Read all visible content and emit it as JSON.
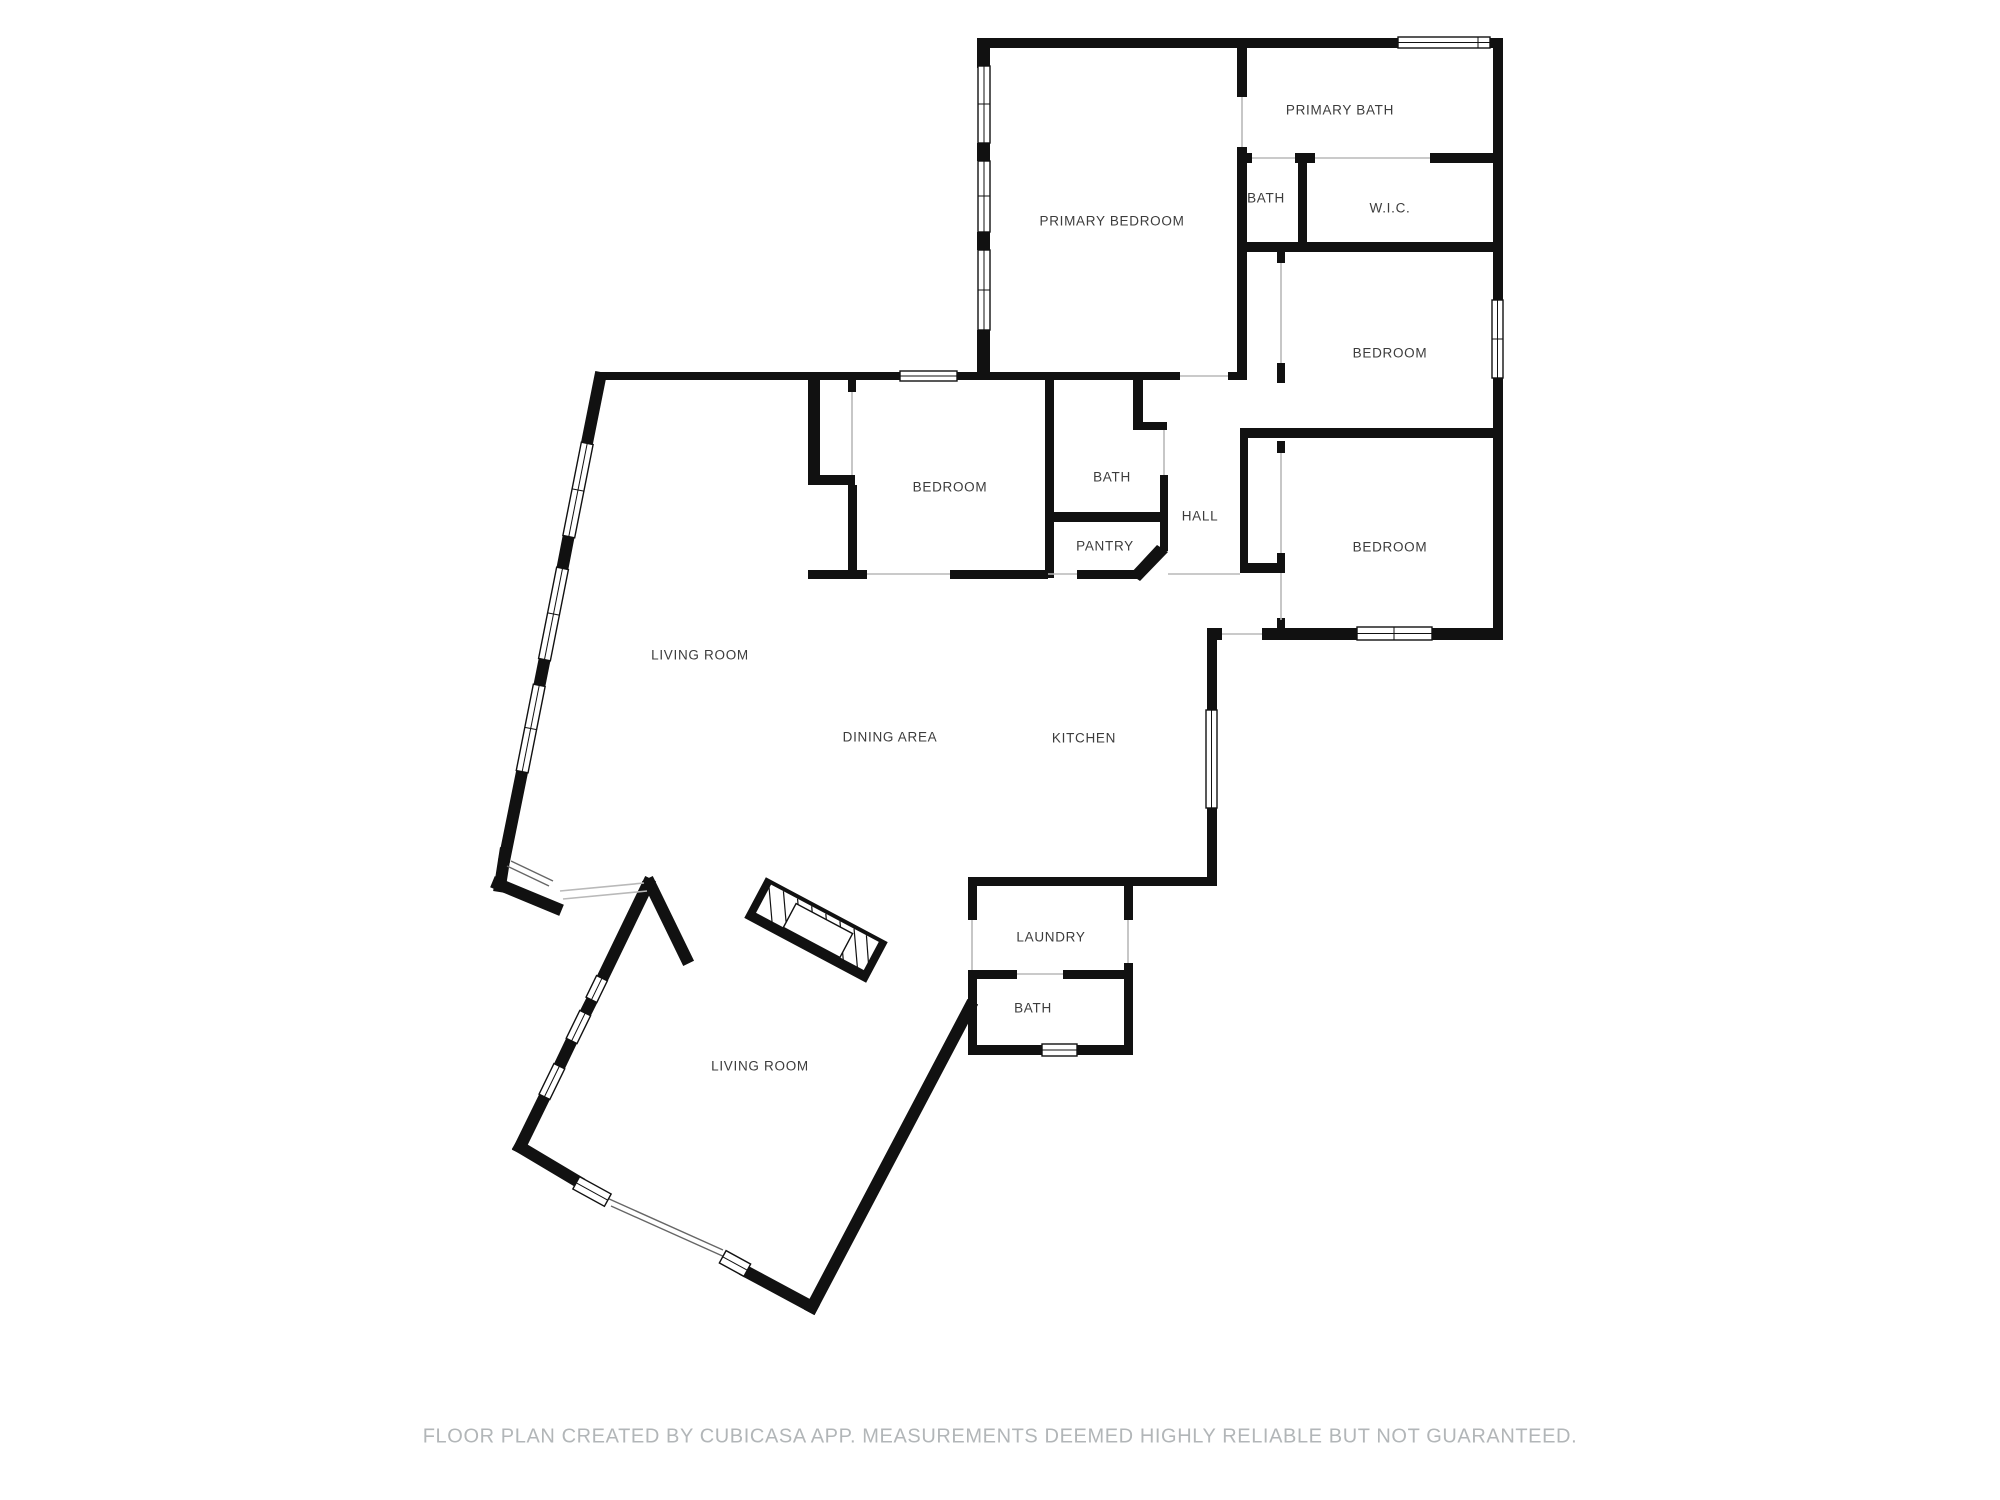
{
  "rooms": [
    {
      "id": "primary-bath",
      "label": "PRIMARY BATH",
      "x": 1340,
      "y": 110
    },
    {
      "id": "primary-bedroom",
      "label": "PRIMARY BEDROOM",
      "x": 1112,
      "y": 221
    },
    {
      "id": "bath-upper",
      "label": "BATH",
      "x": 1266,
      "y": 198
    },
    {
      "id": "wic",
      "label": "W.I.C.",
      "x": 1390,
      "y": 208
    },
    {
      "id": "bedroom-ne",
      "label": "BEDROOM",
      "x": 1390,
      "y": 353
    },
    {
      "id": "bedroom-se",
      "label": "BEDROOM",
      "x": 1390,
      "y": 547
    },
    {
      "id": "hall",
      "label": "HALL",
      "x": 1200,
      "y": 516
    },
    {
      "id": "bedroom-mid",
      "label": "BEDROOM",
      "x": 950,
      "y": 487
    },
    {
      "id": "bath-mid",
      "label": "BATH",
      "x": 1112,
      "y": 477
    },
    {
      "id": "pantry",
      "label": "PANTRY",
      "x": 1105,
      "y": 546
    },
    {
      "id": "living-room-1",
      "label": "LIVING ROOM",
      "x": 700,
      "y": 655
    },
    {
      "id": "dining-area",
      "label": "DINING AREA",
      "x": 890,
      "y": 737
    },
    {
      "id": "kitchen",
      "label": "KITCHEN",
      "x": 1084,
      "y": 738
    },
    {
      "id": "laundry",
      "label": "LAUNDRY",
      "x": 1051,
      "y": 937
    },
    {
      "id": "bath-lower",
      "label": "BATH",
      "x": 1033,
      "y": 1008
    },
    {
      "id": "living-room-2",
      "label": "LIVING ROOM",
      "x": 760,
      "y": 1066
    }
  ],
  "footer": {
    "text": "FLOOR PLAN CREATED BY CUBICASA APP. MEASUREMENTS DEEMED HIGHLY RELIABLE BUT NOT GUARANTEED."
  },
  "colors": {
    "wall": "#111111",
    "label": "#3c3c3c",
    "footer": "#b2b6b8",
    "background": "#ffffff"
  }
}
